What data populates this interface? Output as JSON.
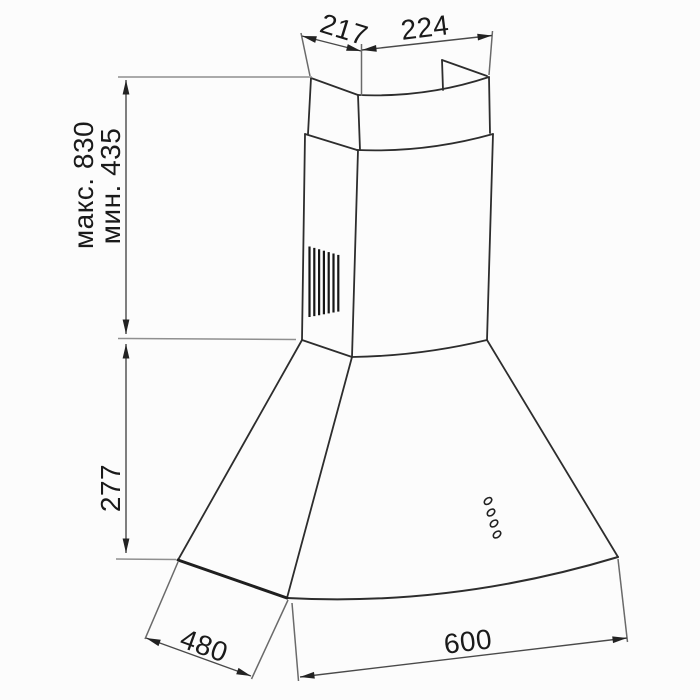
{
  "diagram": {
    "dimension_labels": {
      "top_duct_depth": "217",
      "top_duct_width": "224",
      "mount_height_max": "макс. 830",
      "mount_height_min": "мин. 435",
      "canopy_height": "277",
      "canopy_depth": "480",
      "canopy_width": "600"
    },
    "colors": {
      "background": "#fcfcfc",
      "outline": "#2d2d2d",
      "dimension_line": "#4a4a4a",
      "extension_line": "#8f8f8f",
      "arrow": "#222222",
      "text": "#1a1a1a"
    }
  }
}
